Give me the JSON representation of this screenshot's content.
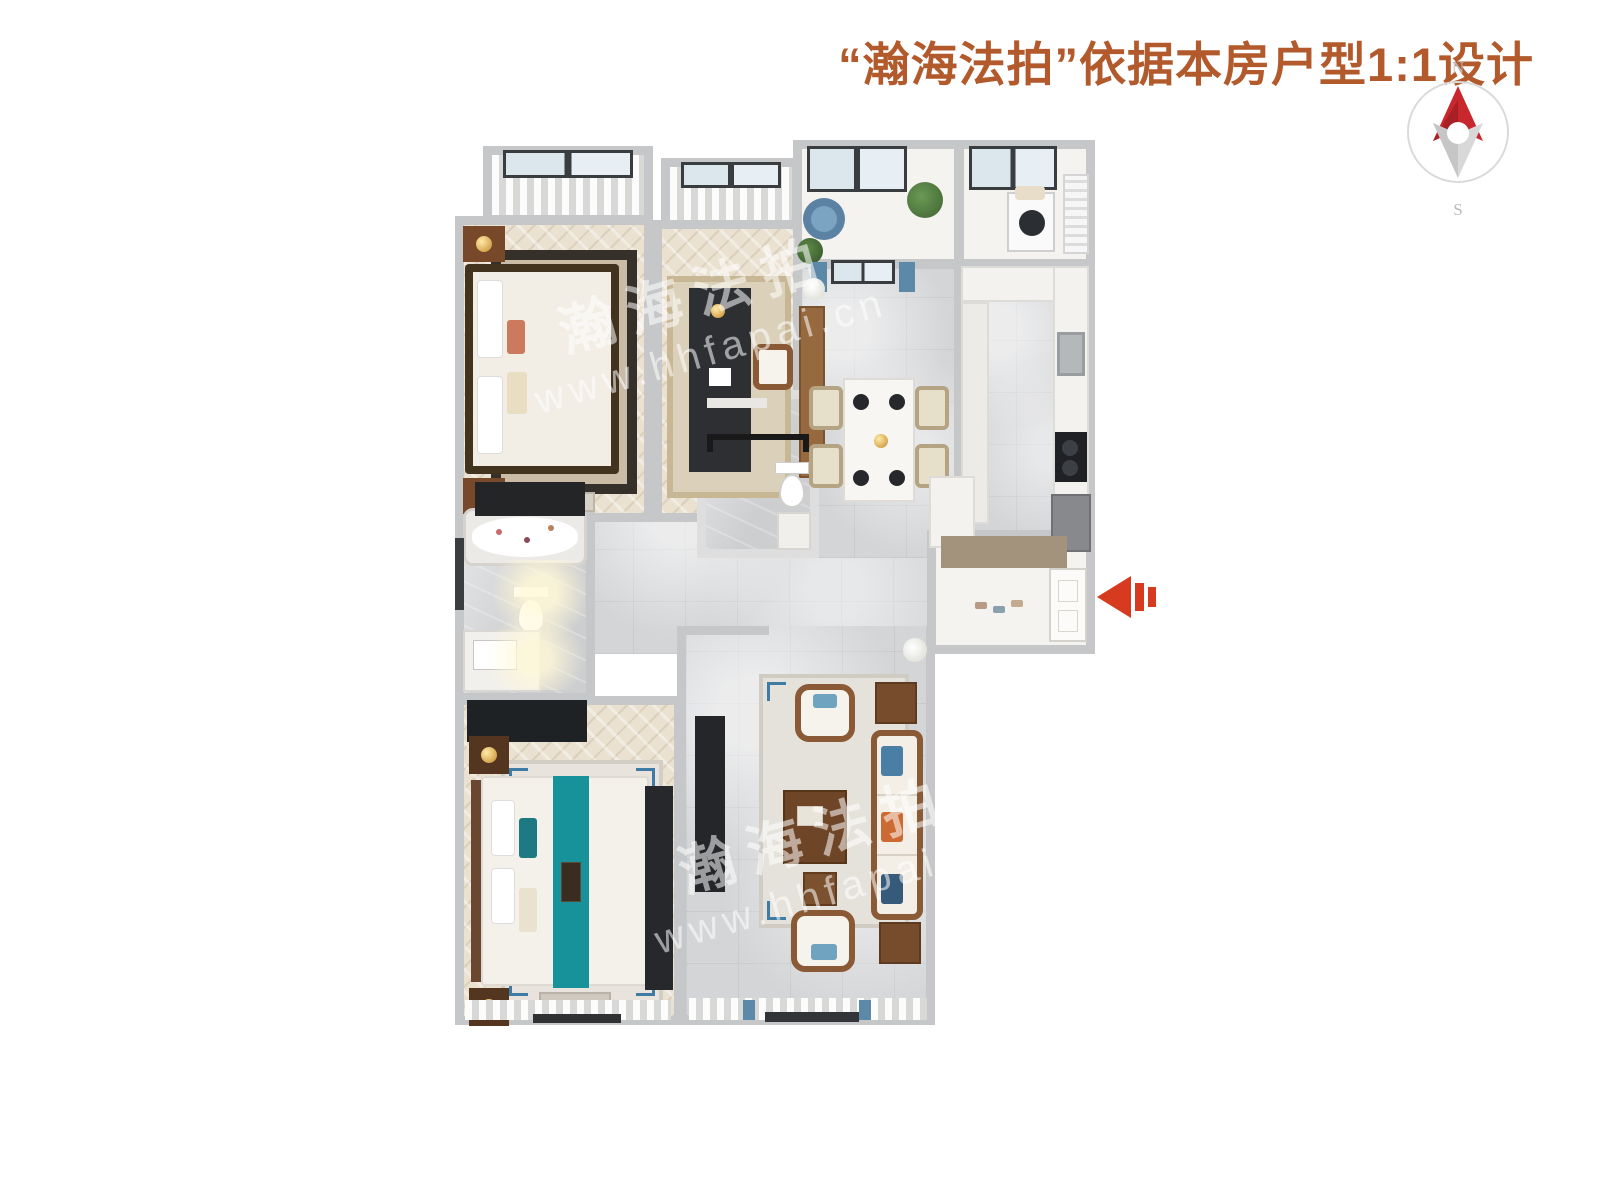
{
  "page": {
    "background": "#ffffff"
  },
  "header": {
    "title": "“瀚海法拍”依据本房户型1:1设计",
    "color": "#b25a2c"
  },
  "compass": {
    "north_label": "N",
    "south_label": "S",
    "ring_color": "#dadada",
    "north_needle_color": "#c8272d",
    "south_needle_color": "#d8d8d8",
    "label_color": "#b9b9b9"
  },
  "entrance_arrow": {
    "icon": "left-arrow-icon",
    "color": "#d63b20",
    "direction": "left"
  },
  "watermark": {
    "brand": "瀚海法拍",
    "url": "www.hhfapai.cn",
    "color": "rgba(255,255,255,0.55)"
  },
  "palette": {
    "wall": "#c5c7c8",
    "wood_floor": "#eae1d1",
    "tile_floor": "#d4d5d7",
    "white_floor": "#f4f3f0",
    "dark_furniture": "#26282c",
    "wood_furniture": "#8a5a36",
    "teal_accent": "#17929b",
    "blue_accent": "#5d89a9",
    "beige": "#e6dfc9",
    "title_color": "#b25a2c",
    "arrow_red": "#d63b20"
  },
  "floorplan": {
    "rooms": [
      "bedroom-north",
      "study",
      "balcony",
      "laundry",
      "dining-room",
      "kitchen",
      "bathroom-small",
      "bathroom-main",
      "hallway",
      "entry",
      "master-bedroom",
      "living-room"
    ]
  }
}
